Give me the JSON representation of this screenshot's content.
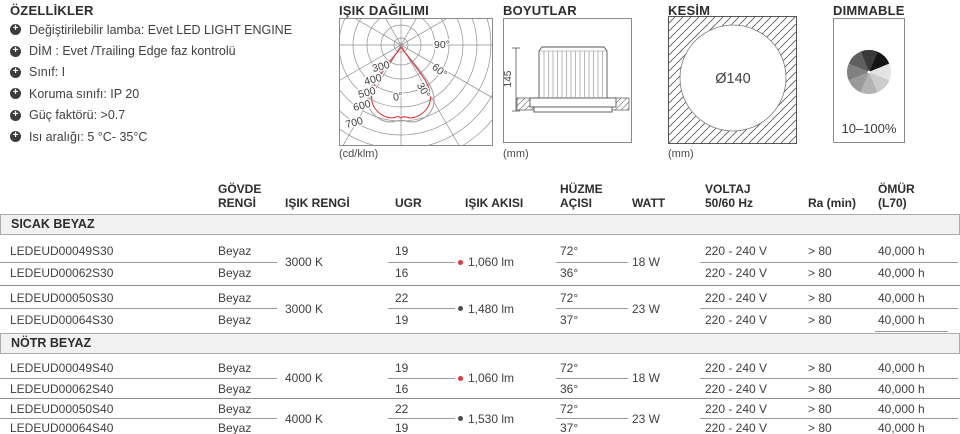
{
  "features": {
    "title": "ÖZELLİKLER",
    "items": [
      "Değiştirilebilir lamba: Evet LED LIGHT ENGINE",
      "DİM : Evet /Trailing Edge faz kontrolü",
      "Sınıf: I",
      "Koruma sınıfı: IP 20",
      "Güç faktörü: >0.7",
      "Isı aralığı: 5 °C- 35°C"
    ]
  },
  "photometry": {
    "title": "IŞIK DAĞILIMI",
    "unit": "(cd/klm)",
    "radial_labels": [
      "300",
      "400",
      "500",
      "600",
      "700"
    ],
    "angle_labels": {
      "a90": "90°",
      "a60": "60°",
      "a30": "30°",
      "a0": "0°"
    },
    "curve_primary": "#e2373c",
    "curve_secondary": "#9a9a9a"
  },
  "dimensions": {
    "title": "BOYUTLAR",
    "unit": "(mm)",
    "height_label": "145"
  },
  "cutout": {
    "title": "KESİM",
    "unit": "(mm)",
    "diameter_label": "Ø140"
  },
  "dimmable": {
    "title": "DIMMABLE",
    "range": "10–100%",
    "wheel_shades": [
      "#3a3a3a",
      "#141414",
      "#e4e4e4",
      "#cccccc",
      "#b3b3b3",
      "#9a9a9a",
      "#808080",
      "#5e5e5e"
    ]
  },
  "table": {
    "headers": {
      "body": "GÖVDE\nRENGİ",
      "light_color": "IŞIK RENGİ",
      "ugr": "UGR",
      "flux": "IŞIK AKISI",
      "beam": "HÜZME\nAÇISI",
      "watt": "WATT",
      "voltage": "VOLTAJ\n50/60 Hz",
      "ra": "Ra (min)",
      "life": "ÖMÜR\n(L70)"
    },
    "sections": [
      {
        "name": "SICAK BEYAZ",
        "groups": [
          {
            "light_color": "3000 K",
            "flux": "1,060 lm",
            "flux_dot": "#e2373c",
            "watt": "18 W",
            "rows": [
              {
                "code": "LEDEUD00049S30",
                "body": "Beyaz",
                "ugr": "19",
                "beam": "72°",
                "voltage": "220 - 240 V",
                "ra": "> 80",
                "life": "40,000 h"
              },
              {
                "code": "LEDEUD00062S30",
                "body": "Beyaz",
                "ugr": "16",
                "beam": "36°",
                "voltage": "220 - 240 V",
                "ra": "> 80",
                "life": "40,000 h"
              }
            ]
          },
          {
            "light_color": "3000 K",
            "flux": "1,480 lm",
            "flux_dot": "#4a4a4a",
            "watt": "23 W",
            "rows": [
              {
                "code": "LEDEUD00050S30",
                "body": "Beyaz",
                "ugr": "22",
                "beam": "72°",
                "voltage": "220 - 240 V",
                "ra": "> 80",
                "life": "40,000 h"
              },
              {
                "code": "LEDEUD00064S30",
                "body": "Beyaz",
                "ugr": "19",
                "beam": "37°",
                "voltage": "220 - 240 V",
                "ra": "> 80",
                "life": "40,000 h"
              }
            ]
          }
        ]
      },
      {
        "name": "NÖTR BEYAZ",
        "groups": [
          {
            "light_color": "4000 K",
            "flux": "1,060 lm",
            "flux_dot": "#e2373c",
            "watt": "18 W",
            "rows": [
              {
                "code": "LEDEUD00049S40",
                "body": "Beyaz",
                "ugr": "19",
                "beam": "72°",
                "voltage": "220 - 240 V",
                "ra": "> 80",
                "life": "40,000 h"
              },
              {
                "code": "LEDEUD00062S40",
                "body": "Beyaz",
                "ugr": "16",
                "beam": "36°",
                "voltage": "220 - 240 V",
                "ra": "> 80",
                "life": "40,000 h"
              }
            ]
          },
          {
            "light_color": "4000 K",
            "flux": "1,530 lm",
            "flux_dot": "#4a4a4a",
            "watt": "23 W",
            "rows": [
              {
                "code": "LEDEUD00050S40",
                "body": "Beyaz",
                "ugr": "22",
                "beam": "72°",
                "voltage": "220 - 240 V",
                "ra": "> 80",
                "life": "40,000 h"
              },
              {
                "code": "LEDEUD00064S40",
                "body": "Beyaz",
                "ugr": "19",
                "beam": "37°",
                "voltage": "220 - 240 V",
                "ra": "> 80",
                "life": "40,000 h"
              }
            ]
          }
        ]
      }
    ]
  }
}
